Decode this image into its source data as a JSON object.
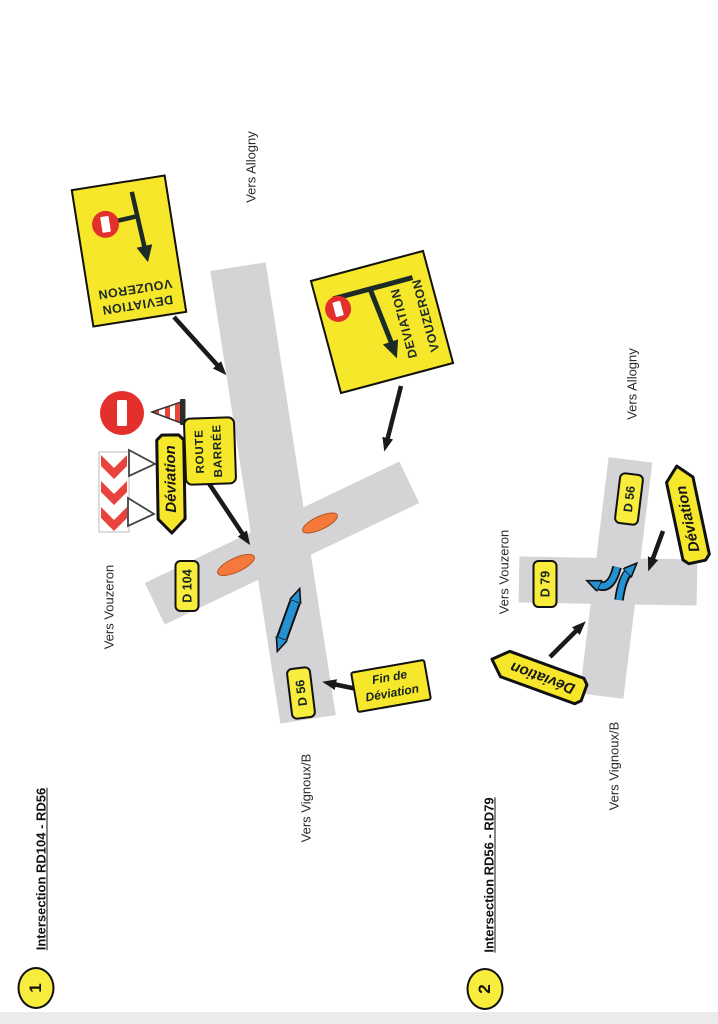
{
  "colors": {
    "sign_yellow": "#f6e72b",
    "label_yellow": "#f8ec3d",
    "road_gray": "#d4d3d6",
    "barrier_orange": "#f4793b",
    "arrow_blue": "#2492d2",
    "signal_red": "#e3302c",
    "ink": "#1d2b26"
  },
  "d1": {
    "num": "1",
    "title": "Intersection RD104 - RD56",
    "vers_allogny": "Vers Allogny",
    "vers_vouzeron": "Vers Vouzeron",
    "vers_vignoux": "Vers Vignoux/B",
    "d104": "D 104",
    "d56": "D 56",
    "panel_top": {
      "l1": "DEVIATION",
      "l2": "VOUZERON"
    },
    "panel_right": {
      "l1": "DEVIATION",
      "l2": "VOUZERON"
    },
    "deviation": "Déviation",
    "route_barree": {
      "l1": "ROUTE",
      "l2": "BARRÉE"
    },
    "fin": {
      "l1": "Fin de",
      "l2": "Déviation"
    }
  },
  "d2": {
    "num": "2",
    "title": "Intersection RD56 - RD79",
    "vers_allogny": "Vers Allogny",
    "vers_vouzeron": "Vers Vouzeron",
    "vers_vignoux": "Vers Vignoux/B",
    "d56": "D 56",
    "d79": "D 79",
    "deviation_right": "Déviation",
    "deviation_left": "Déviation"
  }
}
